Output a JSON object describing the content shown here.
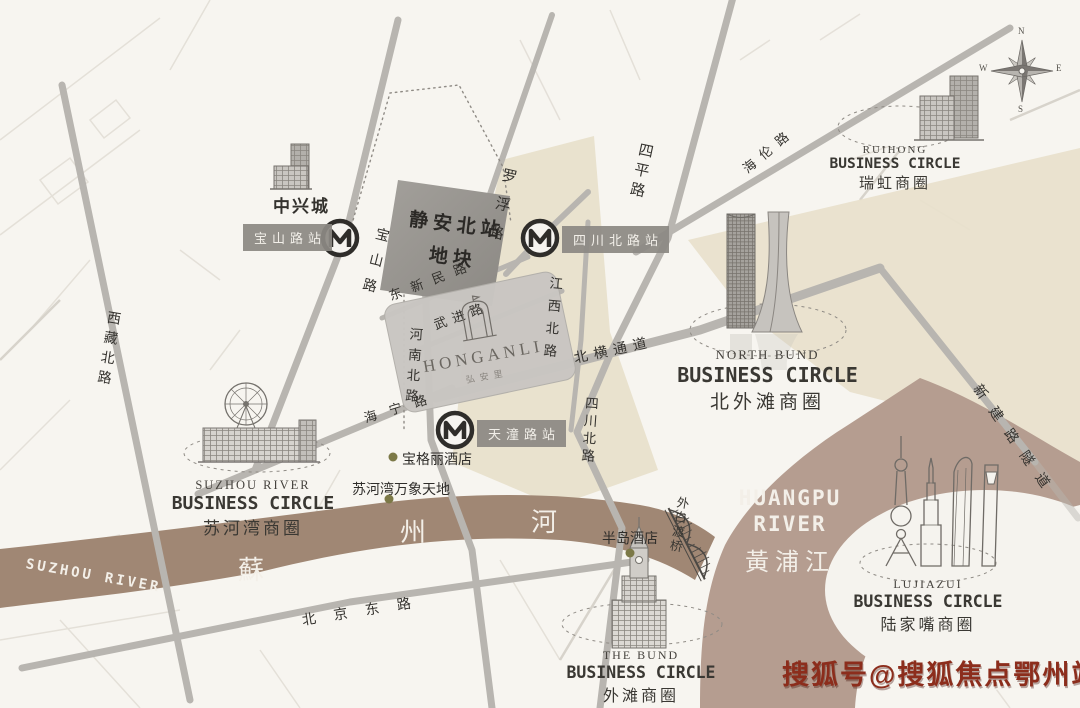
{
  "colors": {
    "land_beige": "#e8e0cb",
    "suzhou_river": "#a08774",
    "huangpu_river": "#b59d90",
    "road_gray": "#b8b5b0",
    "plot_block": "#96938e",
    "project_block": "#c9c6c2",
    "ink": "#34322e",
    "poi_dot": "#7c7947",
    "watermark_red": "#8c2d1c"
  },
  "watermark": "搜狐号@搜狐焦点鄂州站",
  "compass": {
    "n": "N",
    "e": "E",
    "s": "S",
    "w": "W"
  },
  "plot": {
    "line1": "静安北站",
    "line2": "地块"
  },
  "project": {
    "en": "HONGANLI",
    "cn": "弘安里"
  },
  "stations": {
    "baoshan": "宝山路站",
    "sichuan": "四川北路站",
    "tiantong": "天潼路站"
  },
  "roads": {
    "baoshan": "宝山路",
    "henan_north": "河南北路",
    "xizang_north": "西藏北路",
    "luofu": "罗浮路",
    "dongxinmin": "东新民路",
    "wujin": "武进路",
    "jiangxi_north": "江西北路",
    "beiheng": "北横通道",
    "siping": "四平路",
    "sichuan_north": "四川北路",
    "haining": "海宁路",
    "hailun": "海伦路",
    "beijing_east": "北京东路",
    "xinjian_tunnel": "新建路隧道",
    "waibaidu": "外白渡桥"
  },
  "pois": {
    "zhongxingcheng": "中兴城",
    "bulgari": "宝格丽酒店",
    "suhewan_mixc": "苏河湾万象天地",
    "peninsula": "半岛酒店"
  },
  "rivers": {
    "suzhou_en": "SUZHOU RIVER",
    "suzhou_cn": [
      "蘇",
      "州",
      "河"
    ],
    "huangpu_en1": "HUANGPU",
    "huangpu_en2": "RIVER",
    "huangpu_cn": "黃浦江"
  },
  "circles": {
    "ruihong": {
      "en": "RUIHONG",
      "label": "BUSINESS CIRCLE",
      "cn": "瑞虹商圈"
    },
    "north_bund": {
      "en": "NORTH BUND",
      "label": "BUSINESS CIRCLE",
      "cn": "北外滩商圈"
    },
    "suzhou_river": {
      "en": "SUZHOU RIVER",
      "label": "BUSINESS CIRCLE",
      "cn": "苏河湾商圈"
    },
    "the_bund": {
      "en": "THE BUND",
      "label": "BUSINESS CIRCLE",
      "cn": "外滩商圈"
    },
    "lujiazui": {
      "en": "LUJIAZUI",
      "label": "BUSINESS CIRCLE",
      "cn": "陆家嘴商圈"
    }
  }
}
